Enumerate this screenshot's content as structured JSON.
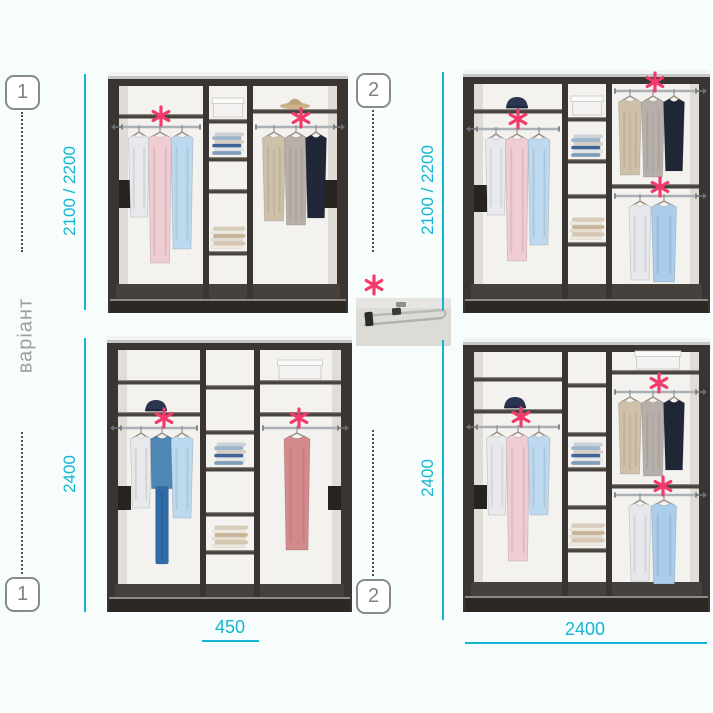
{
  "page": {
    "width": 713,
    "height": 713,
    "background": "#f7fcfd"
  },
  "colors": {
    "dimension": "#14b6cf",
    "marker_pink": "#f23a6d",
    "badge_border": "#878b8e",
    "badge_text": "#7e8285",
    "side_label_text": "#9e9e9e",
    "wardrobe_frame": "#3a3532",
    "wardrobe_interior": "#f3f2ef"
  },
  "side_label": "варіант",
  "badges": {
    "top_left": "1",
    "top_right": "2",
    "bottom_left": "1",
    "bottom_right": "2"
  },
  "marker": {
    "symbol": "*"
  },
  "legend": {
    "marker_symbol": "*"
  },
  "dimensions": {
    "top_left_height": "2100 / 2200",
    "top_right_height": "2100 / 2200",
    "bottom_left_height": "2400",
    "bottom_right_height": "2400",
    "bottom_left_shelf_width": "450",
    "bottom_right_width": "2400"
  },
  "wardrobes": [
    {
      "position": "top-left",
      "variant": "1",
      "height_label": "2100 / 2200",
      "marked_rods": 2,
      "contents": [
        "rod with shirts",
        "center shelves with box and folded clothes",
        "rod with coats",
        "hat on shelf"
      ]
    },
    {
      "position": "top-right",
      "variant": "2",
      "height_label": "2100 / 2200",
      "marked_rods": 3,
      "contents": [
        "cap on shelf",
        "rod with shirts",
        "center shelves with box and folded clothes",
        "upper rod with coats",
        "lower rod with shirts"
      ]
    },
    {
      "position": "bottom-left",
      "variant": "1",
      "height_label": "2400",
      "shelf_width_label": "450",
      "marked_rods": 2,
      "contents": [
        "cap on shelf",
        "rod with shirts and denim outfit",
        "center shelves with folded clothes",
        "box on shelf",
        "rod with dress"
      ]
    },
    {
      "position": "bottom-right",
      "variant": "2",
      "height_label": "2400",
      "width_label": "2400",
      "marked_rods": 3,
      "contents": [
        "cap on shelf",
        "rod with shirts",
        "center shelves with folded clothes",
        "box on shelf",
        "upper rod with coats",
        "lower rod with shirts"
      ]
    }
  ]
}
